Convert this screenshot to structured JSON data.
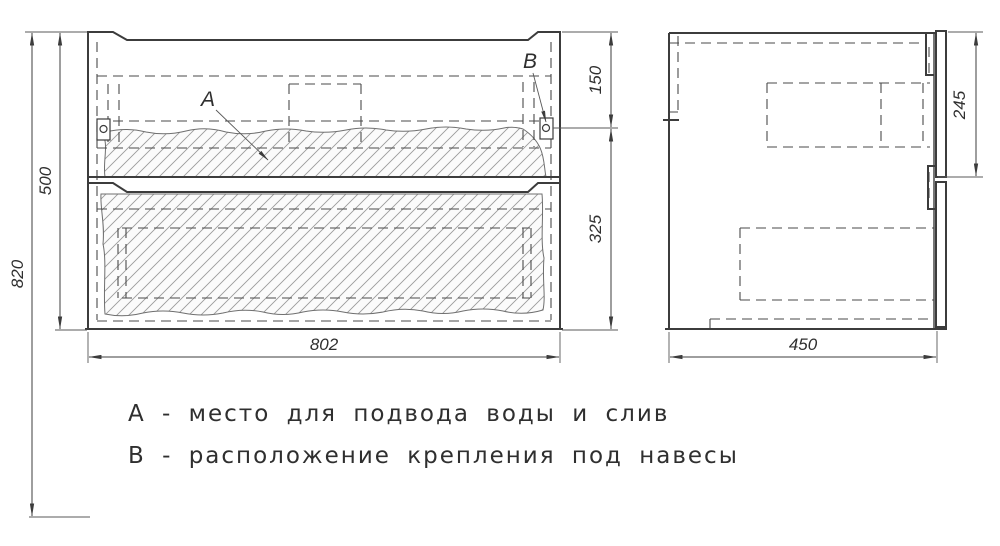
{
  "drawing": {
    "type": "furniture technical drawing — vanity cabinet, front and side views",
    "dimensions": {
      "overall_height": "820",
      "carcass_height": "500",
      "bracket_offset_top": "150",
      "bracket_to_bottom": "325",
      "width": "802",
      "depth": "450",
      "top_front_height": "245"
    },
    "callouts": {
      "a": "А",
      "b": "В"
    },
    "legend": {
      "line_a": "А - место для подвода воды и слив",
      "line_b": "В - расположение крепления под навесы"
    },
    "colors": {
      "background": "#ffffff",
      "line": "#3c3c3c",
      "dashed_line": "#4a4a4a",
      "hatch_line": "#999999",
      "text": "#2f2f2f"
    }
  }
}
